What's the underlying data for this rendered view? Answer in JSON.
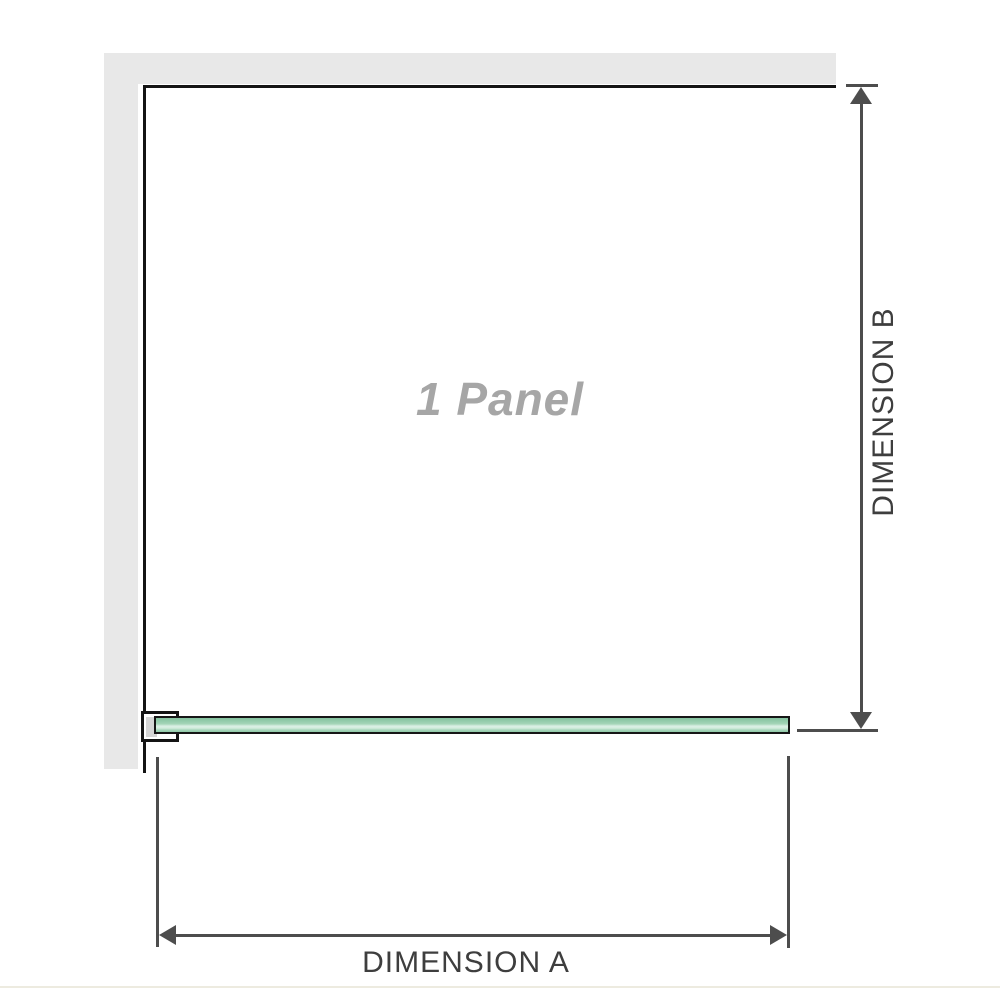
{
  "diagram": {
    "panel_label": "1 Panel",
    "dimension_a_label": "DIMENSION A",
    "dimension_b_label": "DIMENSION B"
  },
  "colors": {
    "background": "#ffffff",
    "wall_fill": "#e8e8e8",
    "panel_outline": "#141414",
    "glass_outline": "#161616",
    "glass_green": "#94ccab",
    "glass_highlight": "#dbf0e5",
    "bracket_fill": "#ffffff",
    "bracket_pad": "#d5d5d5",
    "dimension_line": "#4d4d4d",
    "dimension_text": "#3e3e3e",
    "panel_label_text": "#a6a6a6",
    "footer_rule": "#edebe0"
  },
  "icons": {
    "arrow_up": "css-triangle-up",
    "arrow_down": "css-triangle-down",
    "arrow_left": "css-triangle-left",
    "arrow_right": "css-triangle-right"
  }
}
